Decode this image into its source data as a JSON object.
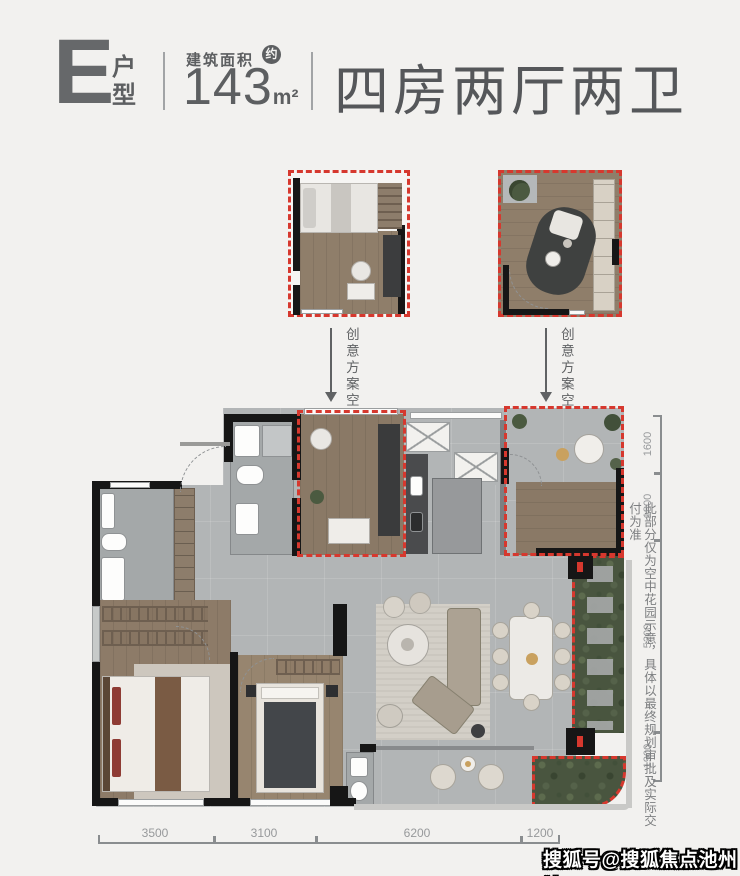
{
  "header": {
    "unit_letter": "E",
    "unit_type_label": "户型",
    "area_label": "建筑面积",
    "approx_badge": "约",
    "area_value": "143",
    "area_unit": "m²",
    "layout_desc": "四房两厅两卫"
  },
  "annotations": {
    "creative_space_labels": [
      "创意方案空间",
      "创意方案空间"
    ],
    "disclaimer": "此部分仅为空中花园示意，具体以最终规划审批及实际交付为准"
  },
  "dimensions": {
    "right": [
      "1600",
      "1800",
      "5200",
      "1900"
    ],
    "bottom": [
      "3500",
      "3100",
      "6200",
      "1200"
    ]
  },
  "watermark": "搜狐号@搜狐焦点池州站",
  "colors": {
    "accent_red": "#d6382e",
    "wall_black": "#161616",
    "floor_tile": "#b2b5b6",
    "floor_wood": "#8a7966",
    "garden_green": "#49553f",
    "heading_text": "#5d5f61",
    "dimension_text": "#97999b"
  }
}
